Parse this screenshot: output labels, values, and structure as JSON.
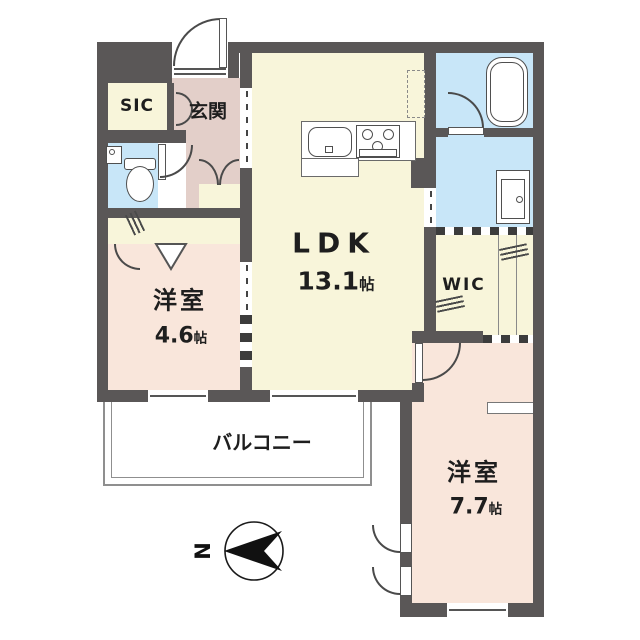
{
  "plan": {
    "rooms": {
      "ldk": {
        "name": "LDK",
        "size_num": "13.1",
        "size_unit": "帖"
      },
      "bedroom_46": {
        "name": "洋室",
        "size_num": "4.6",
        "size_unit": "帖"
      },
      "bedroom_77": {
        "name": "洋室",
        "size_num": "7.7",
        "size_unit": "帖"
      },
      "wic": {
        "name": "WIC"
      },
      "sic": {
        "name": "SIC"
      },
      "entrance": {
        "name": "玄関"
      },
      "balcony": {
        "name": "バルコニー"
      }
    },
    "compass": {
      "label": "N"
    },
    "colors": {
      "wall": "#5a5757",
      "room_cream": "#f8f5da",
      "room_pink": "#f9e6db",
      "hall_pink": "#e3cfc9",
      "wet_blue": "#c8e6f8"
    }
  }
}
